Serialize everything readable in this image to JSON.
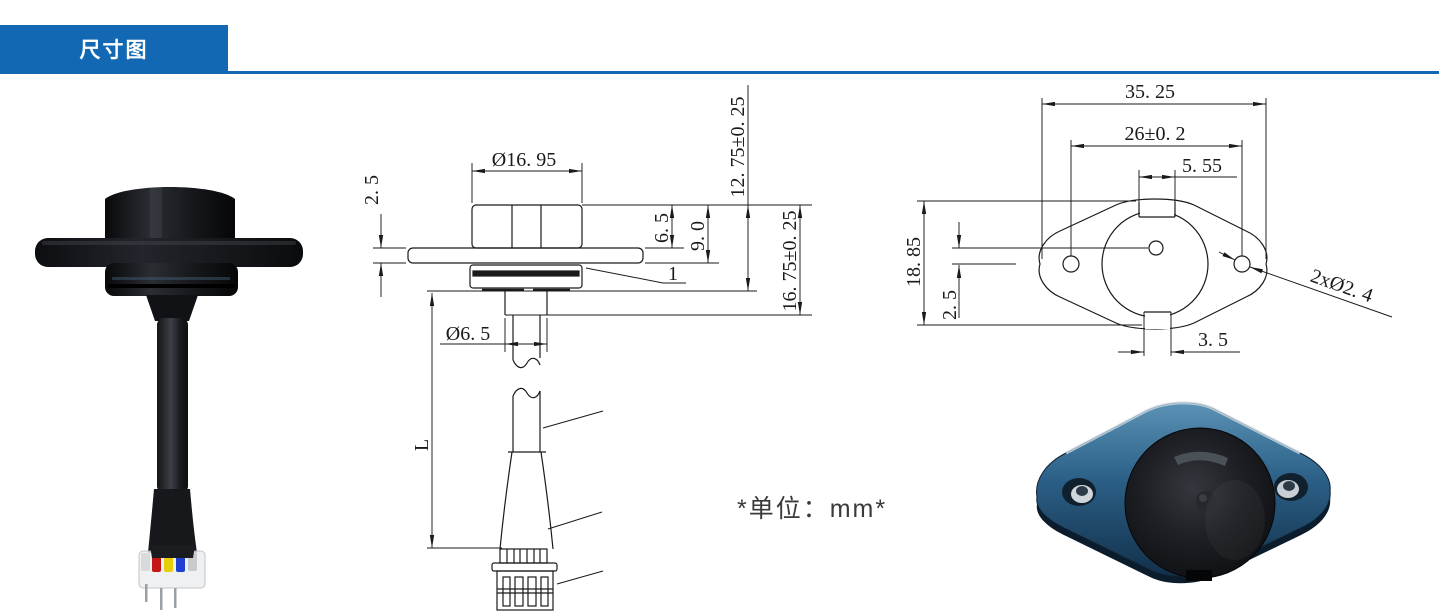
{
  "header": {
    "title": "尺寸图",
    "accent_color": "#1268b2"
  },
  "unit_note": "*单位：mm*",
  "side_view": {
    "dims": {
      "cap_diameter": "Ø16. 95",
      "flange_thickness": "2. 5",
      "cap_height": "6. 5",
      "cap_to_flange": "9. 0",
      "height_to_nut": "12. 75±0. 25",
      "height_to_stem": "16. 75±0. 25",
      "cable_diameter": "Ø6. 5",
      "cable_length": "L",
      "callout_1": "1"
    }
  },
  "top_view": {
    "dims": {
      "flange_width": "35. 25",
      "hole_spacing": "26±0. 2",
      "notch_width": "5. 55",
      "flange_height": "18. 85",
      "center_offset": "2. 5",
      "tab_width": "3. 5",
      "mount_holes": "2xØ2. 4"
    }
  },
  "photo_colors": {
    "body_black": "#141619",
    "flange_blue": "#2b5f86",
    "wire_red": "#c41616",
    "wire_yellow": "#e6cf06",
    "wire_blue": "#1e3fd0",
    "wire_silver": "#c7cbce"
  }
}
